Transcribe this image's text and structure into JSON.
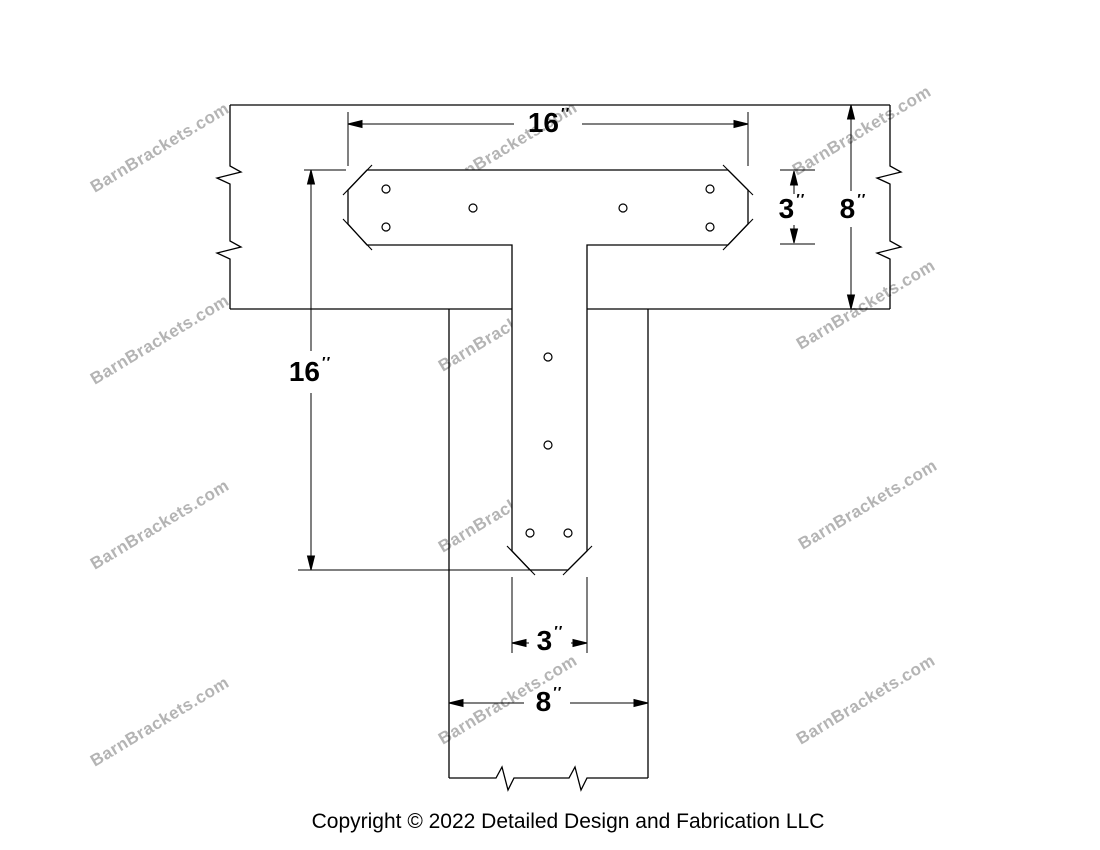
{
  "watermark": {
    "text": "BarnBrackets.com",
    "color": "#b4b4b4"
  },
  "footer": {
    "copyright": "Copyright © 2022 Detailed Design and Fabrication LLC"
  },
  "dimensions": {
    "plate_width_top": {
      "value": "16",
      "unit": "′′"
    },
    "beam_height_right": {
      "value": "8",
      "unit": "′′"
    },
    "plate_bar_height": {
      "value": "3",
      "unit": "′′"
    },
    "plate_height_left": {
      "value": "16",
      "unit": "′′"
    },
    "stem_width_bottom": {
      "value": "3",
      "unit": "′′"
    },
    "post_width_bottom": {
      "value": "8",
      "unit": "′′"
    }
  },
  "drawing": {
    "line_color": "#000000",
    "background": "#ffffff"
  }
}
